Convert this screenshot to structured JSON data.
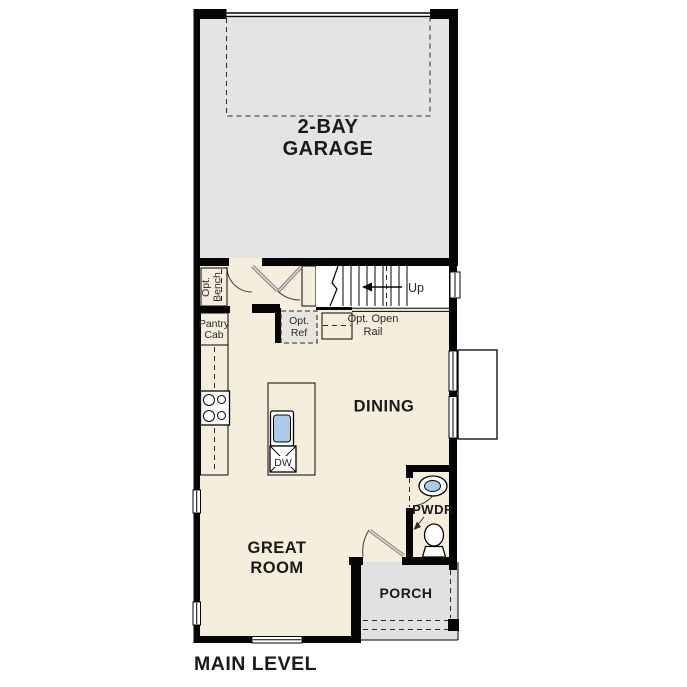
{
  "plan_title": "MAIN LEVEL",
  "colors": {
    "wall": "#050505",
    "interior_floor": "#f6eedd",
    "garage_floor": "#e3e3e3",
    "counter_tan": "#cbbfa3",
    "cabinet_light": "#ece2cb",
    "porch_gray": "#e0e0e0",
    "bay_gray": "#e3e3e3",
    "sink_blue": "#aacae8",
    "ref_box_gray": "#e7e5de",
    "door_leaf_gray": "#8f8f8f"
  },
  "rooms": {
    "garage": {
      "line1": "2-BAY",
      "line2": "GARAGE"
    },
    "dining": {
      "label": "DINING"
    },
    "great_room": {
      "line1": "GREAT",
      "line2": "ROOM"
    },
    "powder": {
      "label": "PWDR"
    },
    "porch": {
      "label": "PORCH"
    }
  },
  "annotations": {
    "stairs_up": "Up",
    "opt_bench": {
      "line1": "Opt.",
      "line2": "Bench"
    },
    "pantry_cab": {
      "line1": "Pantry",
      "line2": "Cab"
    },
    "opt_ref": {
      "line1": "Opt.",
      "line2": "Ref"
    },
    "opt_open_rail": {
      "line1": "Opt. Open",
      "line2": "Rail"
    },
    "dishwasher": "DW"
  }
}
